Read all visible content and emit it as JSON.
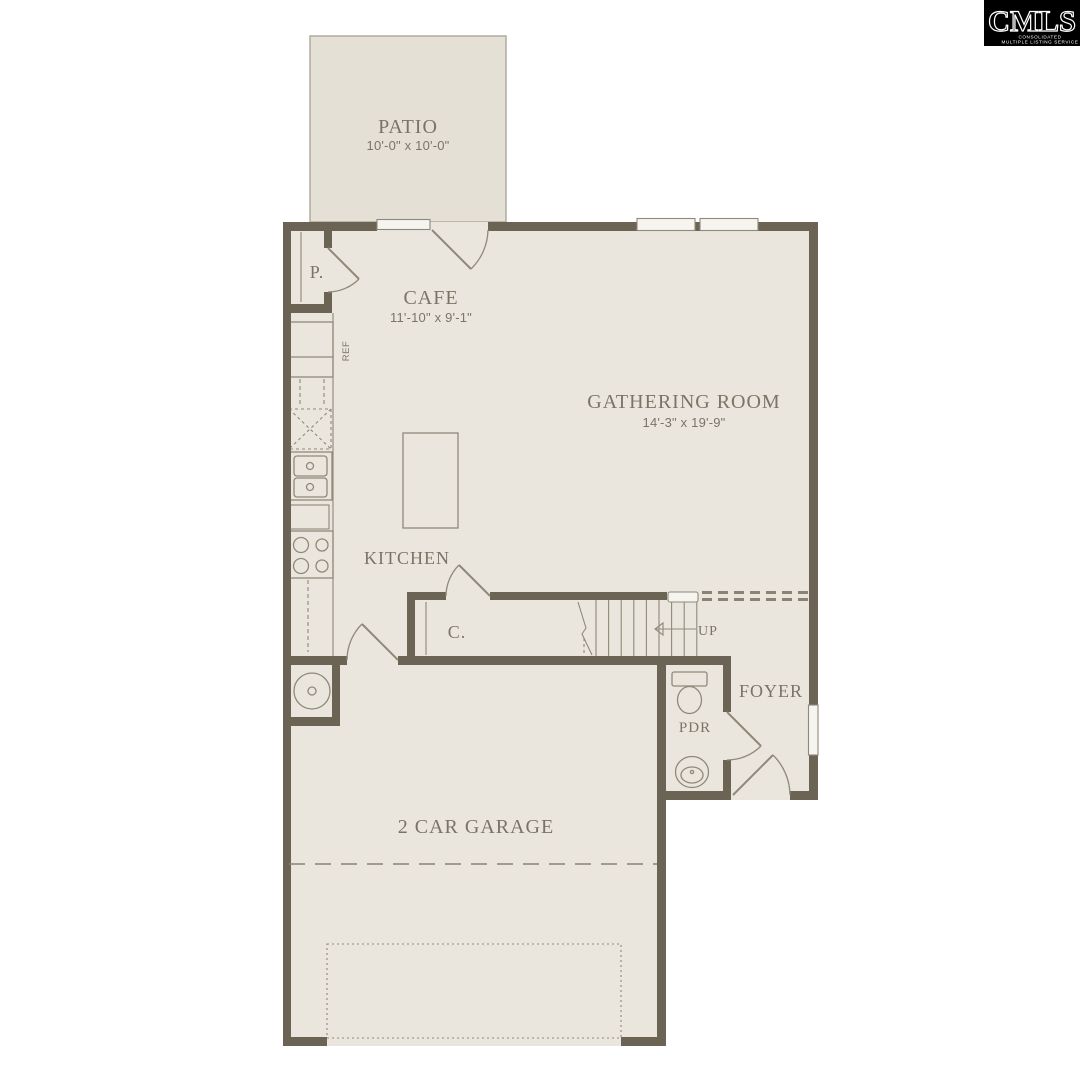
{
  "logo": {
    "name": "CMLS",
    "tagline_line1": "CONSOLIDATED",
    "tagline_line2": "MULTIPLE LISTING SERVICE"
  },
  "floorplan": {
    "patio": {
      "label": "PATIO",
      "dims": "10'-0\" x 10'-0\""
    },
    "cafe": {
      "label": "CAFE",
      "dims": "11'-10\" x 9'-1\""
    },
    "gathering_room": {
      "label": "GATHERING ROOM",
      "dims": "14'-3\" x 19'-9\""
    },
    "kitchen": {
      "label": "KITCHEN"
    },
    "pantry": {
      "label": "P."
    },
    "closet": {
      "label": "C."
    },
    "stairs": {
      "label": "UP"
    },
    "refrigerator": {
      "label": "REF"
    },
    "foyer": {
      "label": "FOYER"
    },
    "powder_room": {
      "label": "PDR"
    },
    "garage": {
      "label": "2 CAR GARAGE"
    }
  },
  "colors": {
    "background": "#ffffff",
    "wall": "#6b6454",
    "floor": "#eae6dd",
    "patio_floor": "#e4e0d6",
    "line": "#8f897a",
    "dashed": "#8a8273",
    "text": "#7b7466",
    "logo_bg": "#000000",
    "logo_text": "#ffffff"
  }
}
